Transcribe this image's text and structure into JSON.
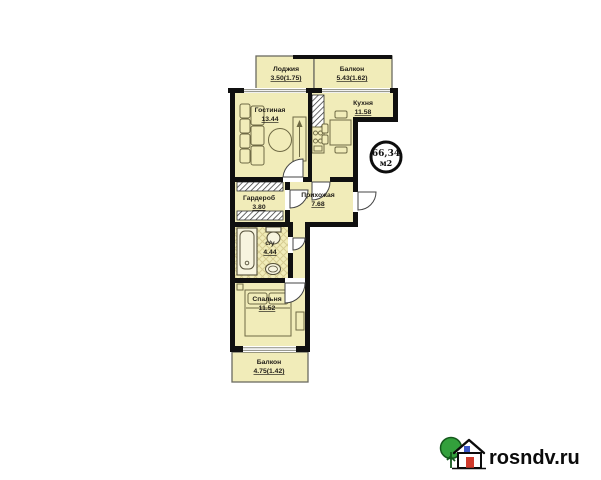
{
  "plan": {
    "title": "apartment-floor-plan",
    "rooms": [
      {
        "id": "loggia",
        "name": "Лоджия",
        "area": "3.50(1.75)"
      },
      {
        "id": "balcony-top",
        "name": "Балкон",
        "area": "5.43(1.62)"
      },
      {
        "id": "living-room",
        "name": "Гостиная",
        "area": "13.44"
      },
      {
        "id": "kitchen",
        "name": "Кухня",
        "area": "11.58"
      },
      {
        "id": "wardrobe",
        "name": "Гардероб",
        "area": "3.80"
      },
      {
        "id": "hallway",
        "name": "Прихожая",
        "area": "7.68"
      },
      {
        "id": "bathroom",
        "name": "с/у",
        "area": "4.44"
      },
      {
        "id": "bedroom",
        "name": "Спальня",
        "area": "11.52"
      },
      {
        "id": "balcony-bottom",
        "name": "Балкон",
        "area": "4.75(1.42)"
      }
    ],
    "badge": {
      "value": "66,34",
      "unit": "м2"
    }
  },
  "watermark": {
    "text": "rosndv.ru"
  },
  "colors": {
    "room_fill": "#f1ecb9",
    "wall": "#101010",
    "tile_pattern": "#d6cc92",
    "window_line": "#8b8b80",
    "tree_green": "#33a03c",
    "house_door_red": "#d03a2b",
    "house_window_blue": "#3a57c9"
  }
}
